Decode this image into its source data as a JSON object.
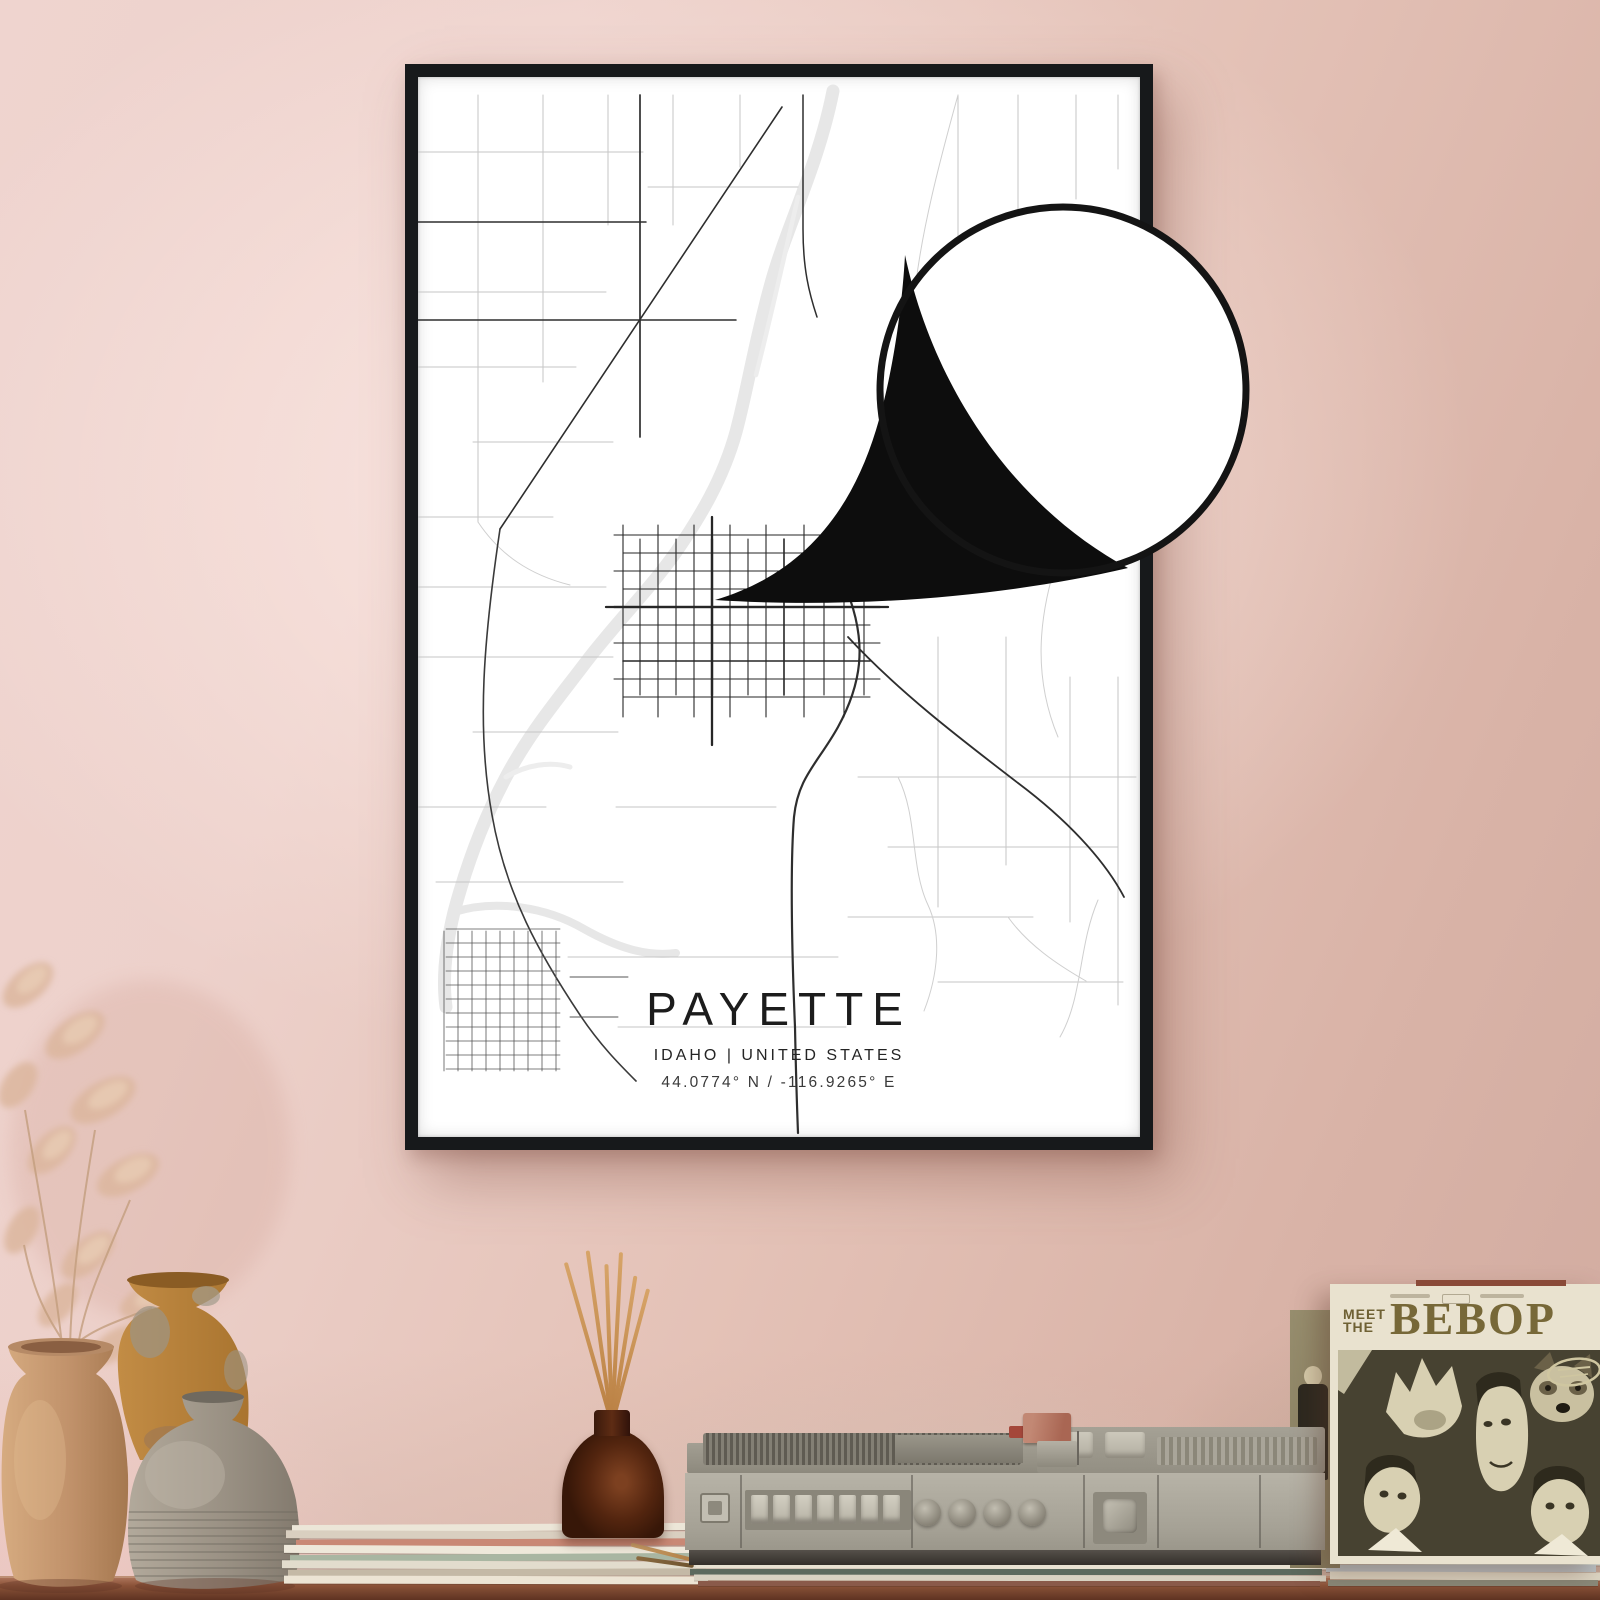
{
  "poster": {
    "title": "PAYETTE",
    "subtitle": "IDAHO | UNITED STATES",
    "coordinates": "44.0774° N / -116.9265° E"
  },
  "record_sleeve": {
    "meet": "MEET",
    "the": "THE",
    "band": "BEBOP"
  },
  "colors": {
    "wall_pink": "#eed3ce",
    "wall_dusty": "#d5afa3",
    "frame_black": "#17191b",
    "poster_white": "#ffffff",
    "map_main_road": "#2e2e2e",
    "map_minor_road": "#c6c6c6",
    "map_river": "#e7e7e7",
    "callout_black": "#0d0d0d",
    "shelf_wood": "#8a5238",
    "player_gray": "#aeaa9f",
    "sleeve_cream": "#e9e2cf",
    "sleeve_olive": "#474231",
    "sleeve_lettering": "#776838",
    "vase_tan": "#c29a72",
    "vase_amber": "#b5803f",
    "vase_gray": "#9a9184",
    "grass_beige": "#dcb79e",
    "reed_stick": "#c9935f"
  }
}
